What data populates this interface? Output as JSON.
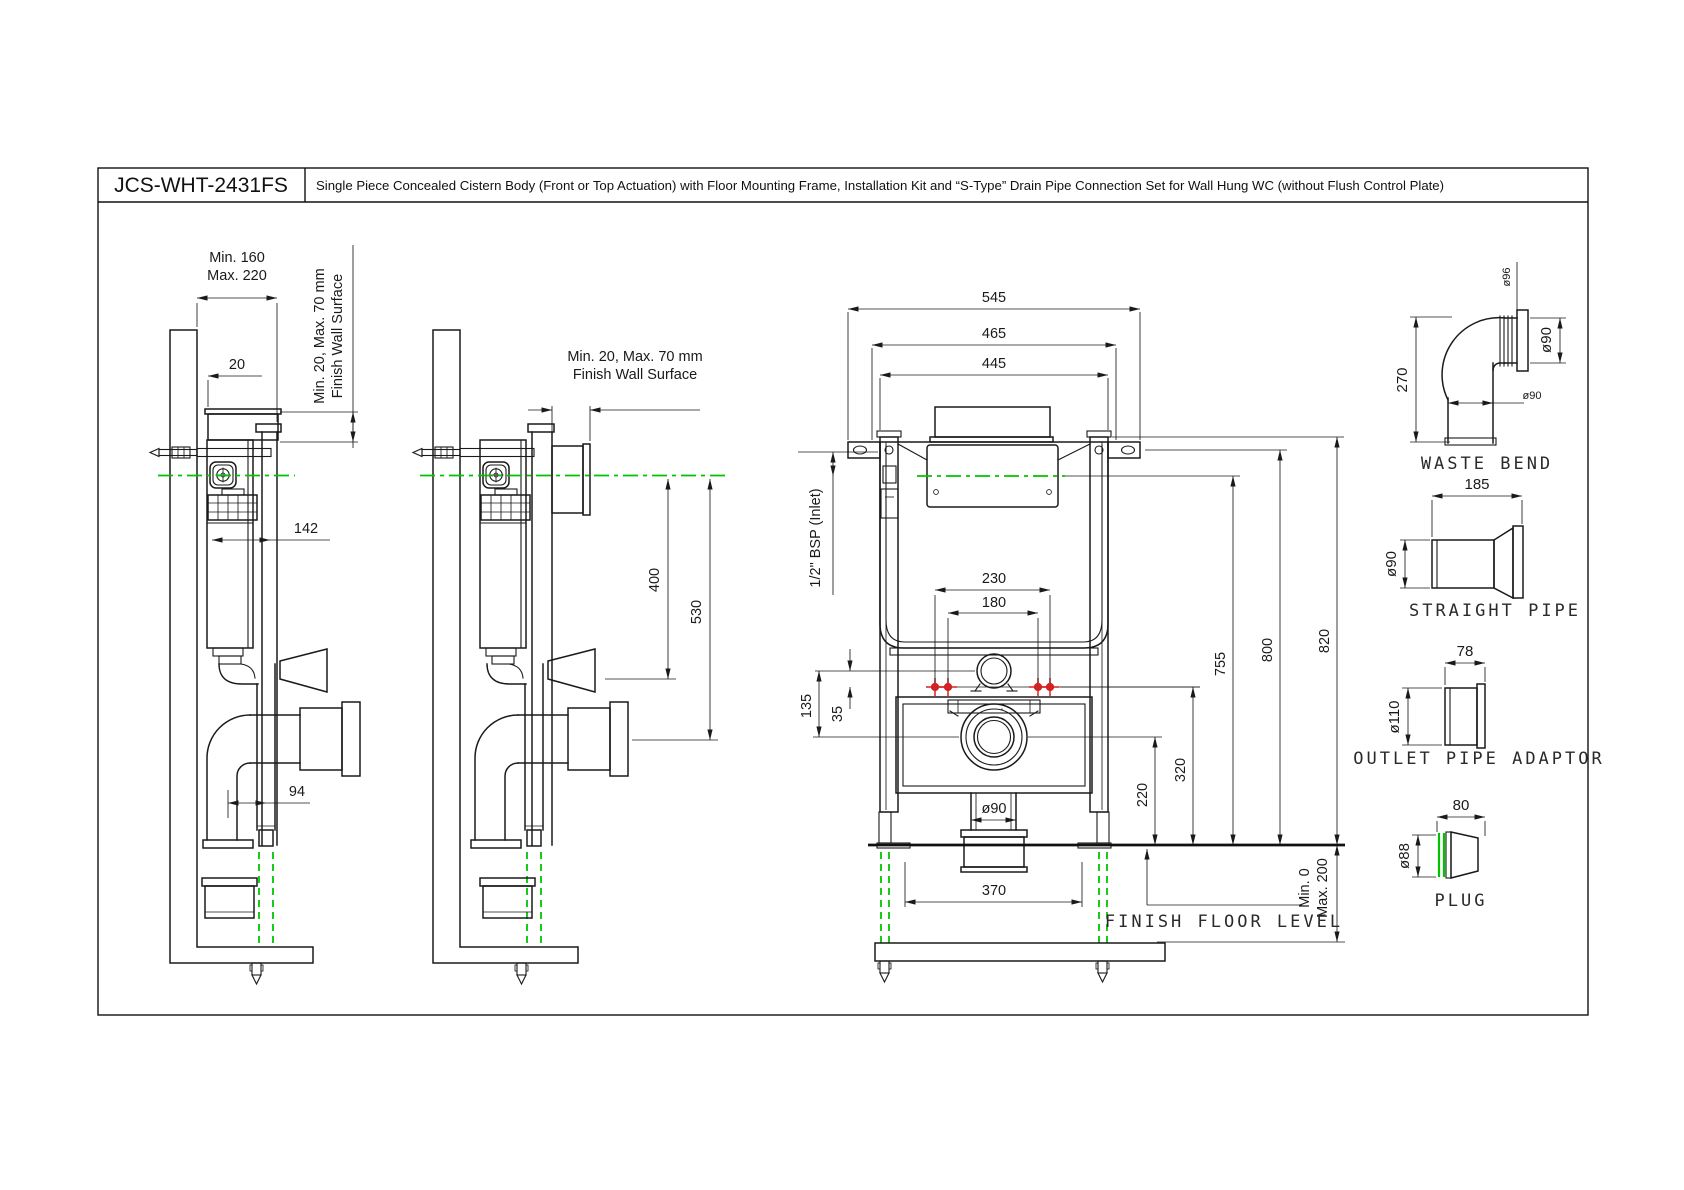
{
  "title_block": {
    "model": "JCS-WHT-2431FS",
    "description": "Single Piece Concealed Cistern Body (Front or Top Actuation) with Floor Mounting Frame, Installation Kit and  “S-Type” Drain Pipe Connection Set for Wall Hung WC (without Flush Control Plate)"
  },
  "colors": {
    "line": "#1a1a1a",
    "centerline_green": "#00c400",
    "fixing_red": "#d42222"
  },
  "v1": {
    "dim_min160": "Min. 160",
    "dim_max220": "Max. 220",
    "dim_20": "20",
    "note1": "Min. 20, Max. 70 mm",
    "note2": "Finish Wall Surface",
    "dim_142": "142",
    "dim_94": "94"
  },
  "v2": {
    "note1": "Min. 20, Max. 70 mm",
    "note2": "Finish Wall Surface",
    "dim_400": "400",
    "dim_530": "530"
  },
  "front": {
    "dim_545": "545",
    "dim_465": "465",
    "dim_445": "445",
    "inlet_note": "1/2\" BSP (Inlet)",
    "dim_230": "230",
    "dim_180": "180",
    "dim_135": "135",
    "dim_35": "35",
    "dim_755": "755",
    "dim_800": "800",
    "dim_820": "820",
    "dim_320": "320",
    "dim_220": "220",
    "dim_d90": "ø90",
    "dim_370": "370",
    "floor_label": "FINISH FLOOR LEVEL",
    "floor_min": "Min. 0",
    "floor_max": "Max. 200"
  },
  "parts": {
    "waste_bend": {
      "label": "WASTE BEND",
      "dim_270": "270",
      "dim_d96": "ø96",
      "dim_d90a": "ø90",
      "dim_d90b": "ø90"
    },
    "straight_pipe": {
      "label": "STRAIGHT PIPE",
      "dim_185": "185",
      "dim_d90": "ø90"
    },
    "outlet_adaptor": {
      "label": "OUTLET PIPE ADAPTOR",
      "dim_78": "78",
      "dim_d110": "ø110"
    },
    "plug": {
      "label": "PLUG",
      "dim_80": "80",
      "dim_d88": "ø88"
    }
  }
}
